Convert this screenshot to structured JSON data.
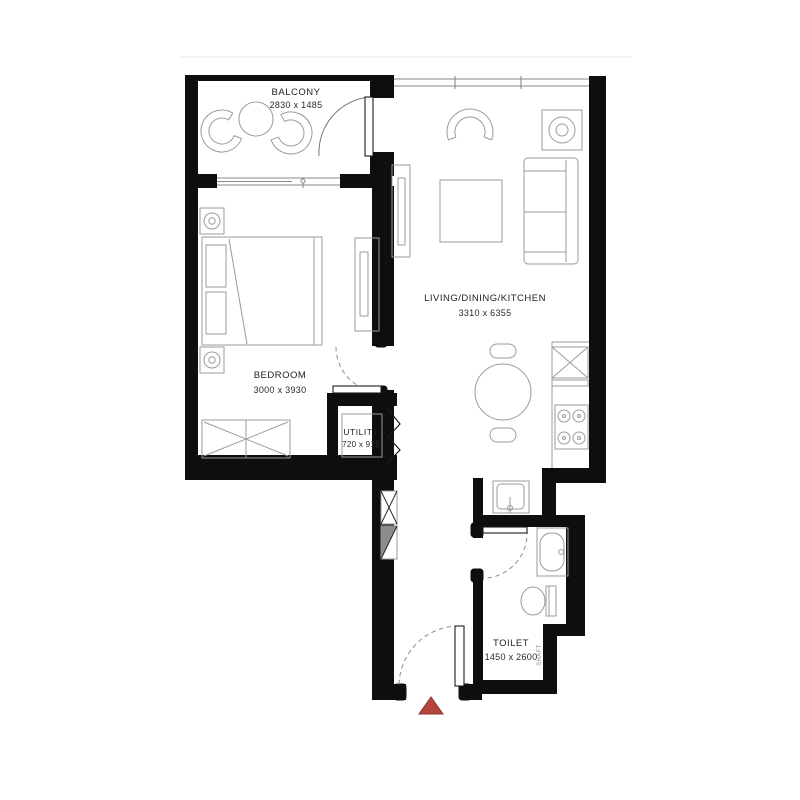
{
  "plan": {
    "rooms": {
      "balcony": {
        "name": "BALCONY",
        "dims": "2830 x 1485"
      },
      "bedroom": {
        "name": "BEDROOM",
        "dims": "3000 x 3930"
      },
      "living_dining_kitchen": {
        "name": "LIVING/DINING/KITCHEN",
        "dims": "3310 x 6355"
      },
      "utility": {
        "name": "UTILITY",
        "dims": "720 x 915"
      },
      "toilet": {
        "name": "TOILET",
        "dims": "1450 x 2600"
      },
      "shaft": {
        "name": "SHAFT"
      }
    },
    "colors": {
      "wall": "#0e0e0e",
      "furniture_line": "#9b9b9b",
      "entrance_marker": "#b2453c",
      "background": "#ffffff"
    }
  }
}
